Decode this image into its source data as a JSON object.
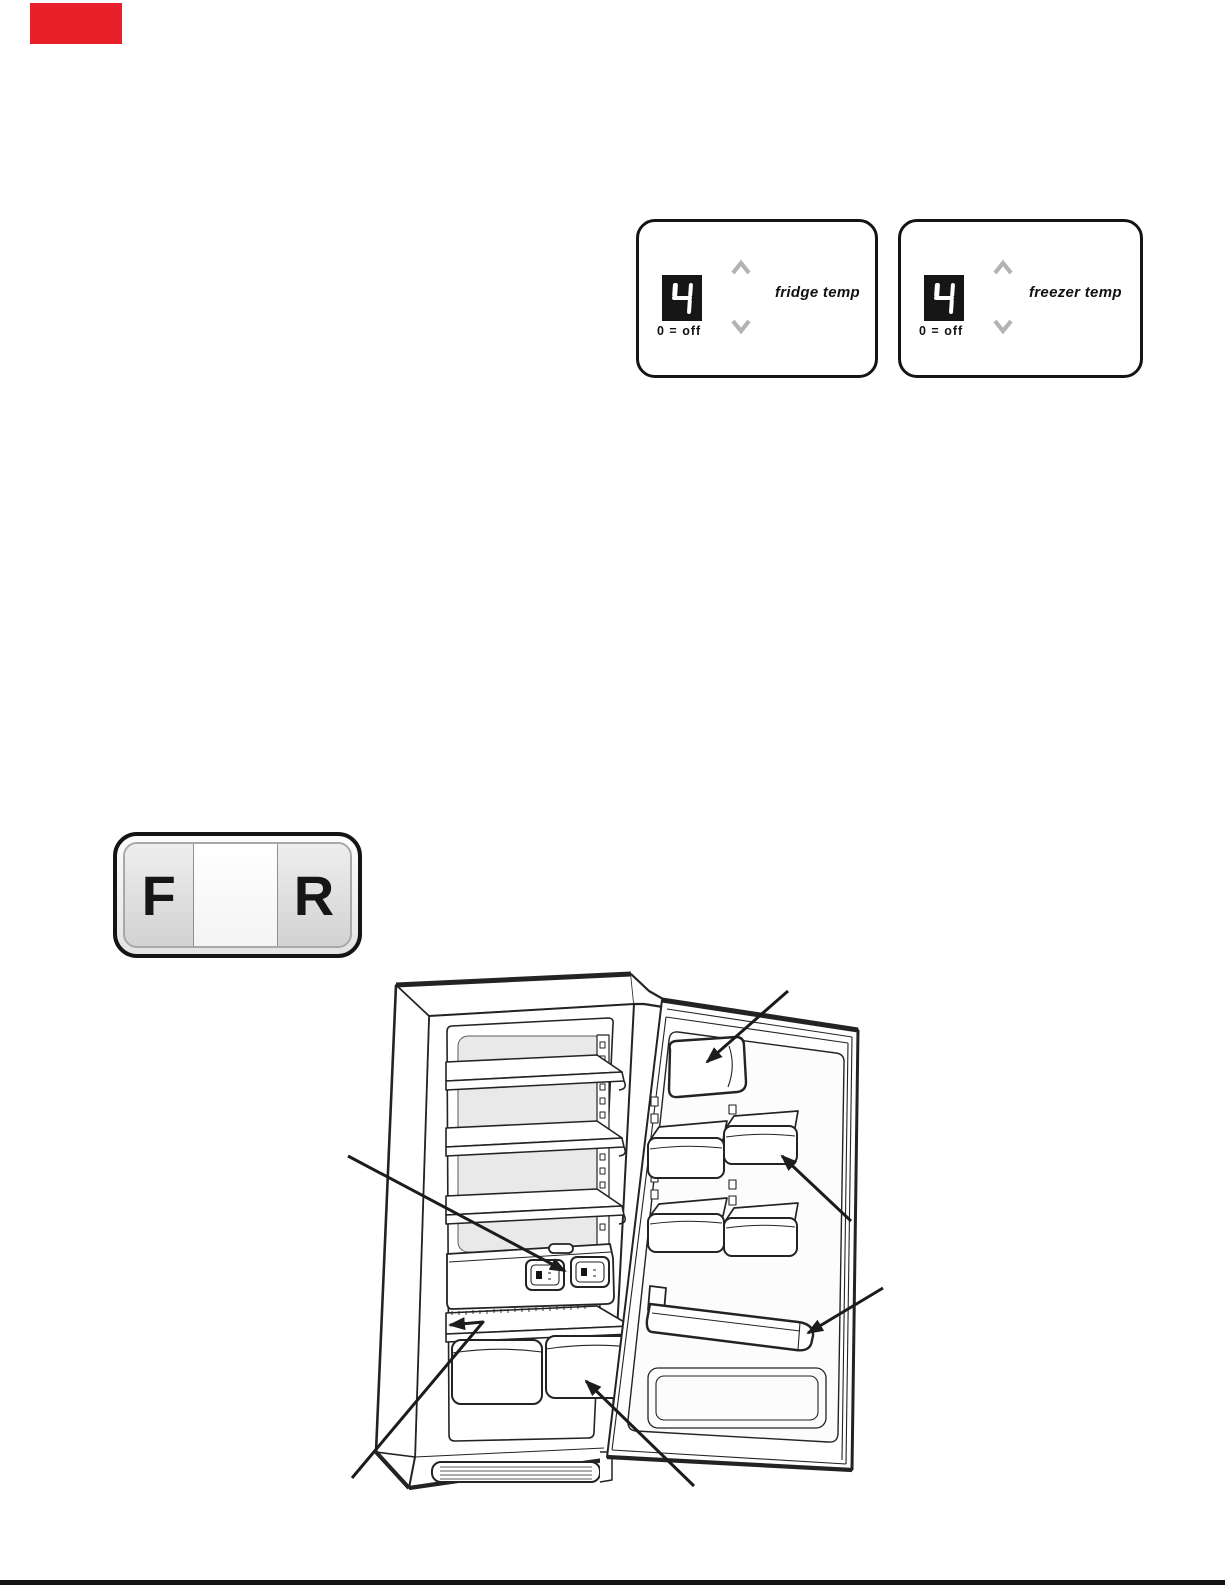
{
  "page": {
    "background": "#ffffff",
    "footer_rule_color": "#141414"
  },
  "red_tab": {
    "color": "#e8202a"
  },
  "temp_controls": {
    "display_bg": "#161616",
    "digit_color": "#ffffff",
    "chevron_color": "#b3b3b3",
    "fridge": {
      "value": "4",
      "off_note": "0 = off",
      "label": "fridge temp"
    },
    "freezer": {
      "value": "4",
      "off_note": "0 = off",
      "label": "freezer temp"
    }
  },
  "model_badge": {
    "left_letter": "F",
    "right_letter": "R"
  },
  "figure": {
    "subject": "refrigerator-open-door-line-drawing",
    "callouts": [
      "dairy-compartment-arrow",
      "door-shelf-arrow",
      "temperature-controls-arrow",
      "shelf-above-crispers-arrow",
      "crisper-bin-arrow",
      "bottle-trough-arrow"
    ]
  }
}
